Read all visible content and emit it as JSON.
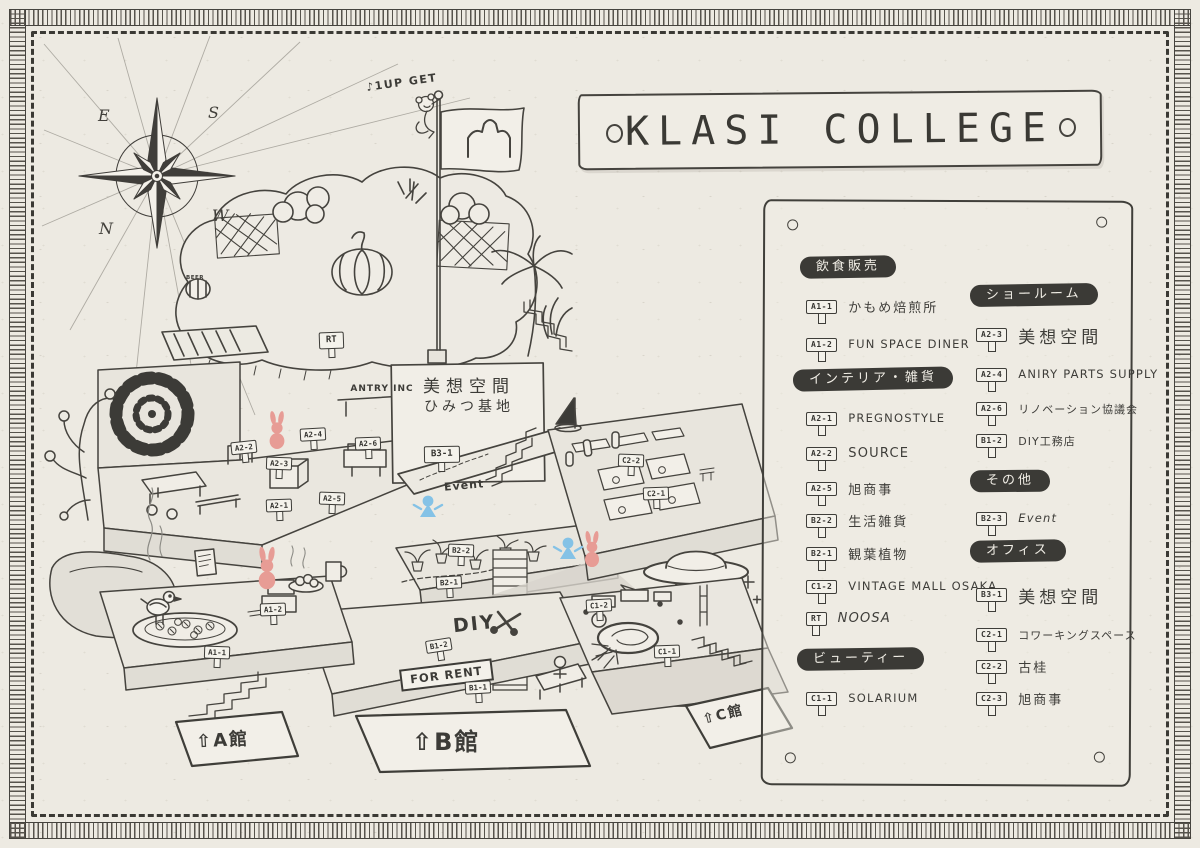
{
  "title": "KLASI COLLEGE",
  "compass": {
    "n": "N",
    "e": "E",
    "s": "S",
    "w": "W"
  },
  "map": {
    "flag_banner": "♪1UP GET",
    "beer_label": "BEER",
    "antry_label": "ANTRY INC",
    "board_line1": "美想空間",
    "board_line2": "ひみつ基地",
    "event_label": "Event",
    "diy_label": "DIY",
    "for_rent_label": "FOR RENT",
    "building_a": "⇧A館",
    "building_b": "⇧B館",
    "building_c": "⇧C館",
    "signs": [
      {
        "code": "A1-1"
      },
      {
        "code": "A1-2"
      },
      {
        "code": "A2-1"
      },
      {
        "code": "A2-2"
      },
      {
        "code": "A2-3"
      },
      {
        "code": "A2-4"
      },
      {
        "code": "A2-5"
      },
      {
        "code": "A2-6"
      },
      {
        "code": "B3-1"
      },
      {
        "code": "B2-1"
      },
      {
        "code": "B2-2"
      },
      {
        "code": "B1-1"
      },
      {
        "code": "B1-2"
      },
      {
        "code": "C2-1"
      },
      {
        "code": "C2-2"
      },
      {
        "code": "C1-1"
      },
      {
        "code": "C1-2"
      },
      {
        "code": "RT"
      }
    ]
  },
  "legend": {
    "columns": [
      {
        "sections": [
          {
            "header": "飲食販売",
            "items": [
              {
                "code": "A1-1",
                "label": "かもめ焙煎所"
              },
              {
                "code": "A1-2",
                "label": "FUN SPACE DINER"
              }
            ]
          },
          {
            "header": "インテリア・雑貨",
            "items": [
              {
                "code": "A2-1",
                "label": "PREGNOSTYLE"
              },
              {
                "code": "A2-2",
                "label": "SOURCE"
              },
              {
                "code": "A2-5",
                "label": "旭商事"
              },
              {
                "code": "B2-2",
                "label": "生活雑貨"
              },
              {
                "code": "B2-1",
                "label": "観葉植物"
              },
              {
                "code": "C1-2",
                "label": "VINTAGE MALL OSAKA"
              },
              {
                "code": "RT",
                "label": "NOOSA"
              }
            ]
          },
          {
            "header": "ビューティー",
            "items": [
              {
                "code": "C1-1",
                "label": "SOLARIUM"
              }
            ]
          }
        ]
      },
      {
        "sections": [
          {
            "header": "ショールーム",
            "items": [
              {
                "code": "A2-3",
                "label": "美想空間"
              },
              {
                "code": "A2-4",
                "label": "ANIRY PARTS SUPPLY"
              },
              {
                "code": "A2-6",
                "label": "リノベーション協議会"
              },
              {
                "code": "B1-2",
                "label": "DIY工務店"
              }
            ]
          },
          {
            "header": "その他",
            "items": [
              {
                "code": "B2-3",
                "label": "Event"
              }
            ]
          },
          {
            "header": "オフィス",
            "items": [
              {
                "code": "B3-1",
                "label": "美想空間"
              },
              {
                "code": "C2-1",
                "label": "コワーキングスペース"
              },
              {
                "code": "C2-2",
                "label": "古桂"
              },
              {
                "code": "C2-3",
                "label": "旭商事"
              }
            ]
          }
        ]
      }
    ]
  }
}
